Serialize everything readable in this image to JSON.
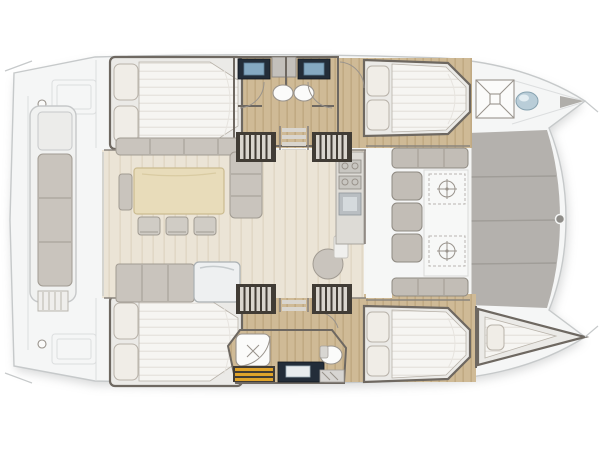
{
  "floorplan": {
    "type": "boat-deck-plan",
    "vessel": "catamaran",
    "view": "top-down",
    "orientation": "bow-right-stern-left",
    "areas": [
      "aft-cockpit-with-bench",
      "saloon-dinette-with-table-and-chairs",
      "sideboard-with-sink",
      "galley-with-stove-and-sink",
      "forward-cockpit-with-bench-and-table",
      "solid-foredeck-platform",
      "port-aft-double-cabin",
      "port-forward-double-cabin",
      "starboard-aft-double-cabin",
      "starboard-forward-double-cabin",
      "starboard-bow-single-berth",
      "port-aft-head-with-shower",
      "port-forward-head-with-shower",
      "starboard-head-with-shower-and-wc",
      "port-bow-locker-with-hatch-and-sink",
      "four-companionway-stairs",
      "two-center-ladders"
    ],
    "furniture_counts": {
      "double_beds": 4,
      "single_bow_berths": 1,
      "dining_chairs": 3,
      "wash_basins": 4,
      "toilets": 1,
      "stair_blocks": 4
    }
  },
  "colors": {
    "background": "#ffffff",
    "deck": "#f5f6f6",
    "deck_line": "#c6c9ca",
    "deck_faint": "#dcdedf",
    "shadow": "#a6a8a9",
    "wall_dark": "#6e6861",
    "frame_gray": "#8a847d",
    "hull_wood": "#cfba96",
    "hull_wood_line": "#c1aa83",
    "saloon_floor": "#ebe4d6",
    "saloon_floor_line": "#e1d8c6",
    "mattress": "#f6f5f2",
    "mattress_line": "#e7e4df",
    "pillow": "#f0ede7",
    "pillow_line": "#b8b2a9",
    "cushion": "#c9c4bd",
    "cushion_line": "#a19b92",
    "table_wood": "#e8dcba",
    "table_wood_line": "#cbbb90",
    "chair": "#d0ccc5",
    "counter_dark": "#232d39",
    "sink_blue": "#85a9c2",
    "fixture_white": "#fbfbfa",
    "fixture_line": "#99938c",
    "stair_frame": "#413c35",
    "stair_slat": "#d9d5ce",
    "teak_slat": "#e0a42b",
    "foredeck": "#b4b1ad",
    "foredeck_line": "#a09d98",
    "bench_panel": "#c2bdb6",
    "bench_panel_line": "#8f8a82",
    "glass_blue": "#b9cdd8",
    "white_area": "#f6f7f6"
  }
}
